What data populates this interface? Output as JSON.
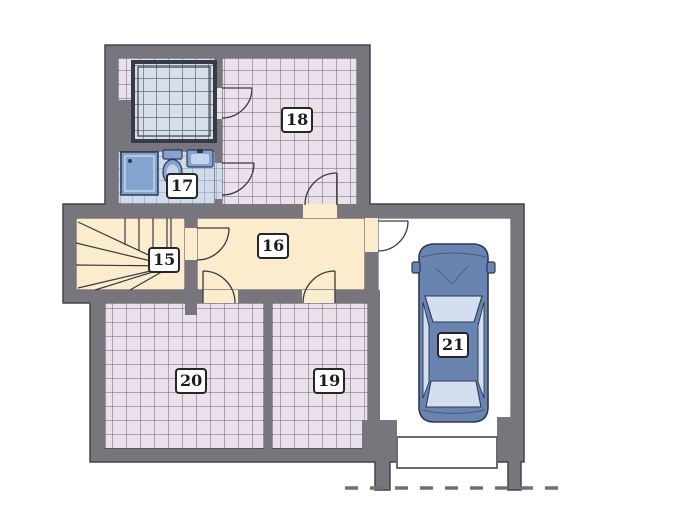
{
  "plan": {
    "type": "floor-plan",
    "rooms": [
      {
        "number": "15"
      },
      {
        "number": "16"
      },
      {
        "number": "17"
      },
      {
        "number": "18"
      },
      {
        "number": "19"
      },
      {
        "number": "20"
      },
      {
        "number": "21"
      }
    ],
    "elements": [
      "stairs",
      "sauna",
      "shower",
      "toilet",
      "washbasin",
      "car",
      "garage-door",
      "driveway-dashed-line",
      "door-swings"
    ]
  },
  "colors": {
    "wall": "#76767c",
    "outline": "#43434b",
    "pink_tile": "#ebe1eb",
    "pink_line": "#6e6070",
    "blue_tile": "#cfdbe8",
    "blue_line": "#8097b2",
    "sauna_tile": "#d7e0ea",
    "sauna_line": "#4a5564",
    "sauna_border": "#363c46",
    "cream": "#faeccd",
    "garage_floor": "#ffffff",
    "fixture": "#84a3cf",
    "fixture_light": "#c6d5ea",
    "fixture_outline": "#2e3a52",
    "car_body": "#6a84b2",
    "car_outline": "#2b3950",
    "glass": "#d3dfef",
    "dash": "#6f6f75",
    "door_line": "#3a3a40"
  }
}
